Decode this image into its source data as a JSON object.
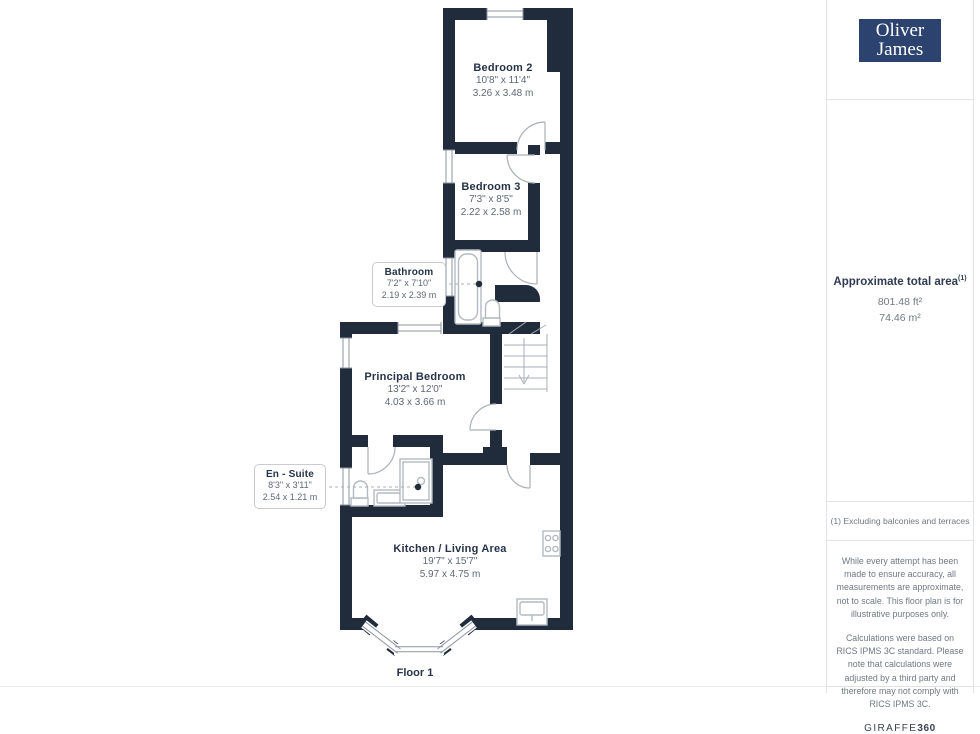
{
  "brand": {
    "logo_line1": "Oliver",
    "logo_line2": "James"
  },
  "floor_label": "Floor 1",
  "rooms": [
    {
      "name": "Bedroom 2",
      "imperial": "10'8\" x 11'4\"",
      "metric": "3.26 x 3.48 m"
    },
    {
      "name": "Bedroom 3",
      "imperial": "7'3\" x 8'5\"",
      "metric": "2.22 x 2.58 m"
    },
    {
      "name": "Bathroom",
      "imperial": "7'2\" x 7'10\"",
      "metric": "2.19 x 2.39 m"
    },
    {
      "name": "Principal Bedroom",
      "imperial": "13'2\" x 12'0\"",
      "metric": "4.03 x 3.66 m"
    },
    {
      "name": "En - Suite",
      "imperial": "8'3\" x 3'11\"",
      "metric": "2.54 x 1.21 m"
    },
    {
      "name": "Kitchen / Living Area",
      "imperial": "19'7\" x 15'7\"",
      "metric": "5.97 x 4.75 m"
    }
  ],
  "sidebar": {
    "area_title": "Approximate total area",
    "area_superscript": "(1)",
    "area_ft": "801.48 ft²",
    "area_m": "74.46 m²",
    "footnote": "(1) Excluding balconies and terraces",
    "disclaimer_p1": "While every attempt has been made to ensure accuracy, all measurements are approximate, not to scale. This floor plan is for illustrative purposes only.",
    "disclaimer_p2": "Calculations were based on RICS IPMS 3C standard. Please note that calculations were adjusted by a third party and therefore may not comply with RICS IPMS 3C.",
    "giraffe_brand": "GIRAFFE",
    "giraffe_suffix": "360"
  },
  "colors": {
    "wall": "#202c3b",
    "fixture_line": "#b3bac3",
    "door_line": "#a9b0b9",
    "label_ink": "#263349",
    "dim_text": "#5e6877",
    "logo_bg": "#2b436e",
    "divider": "#dfe2e6"
  }
}
